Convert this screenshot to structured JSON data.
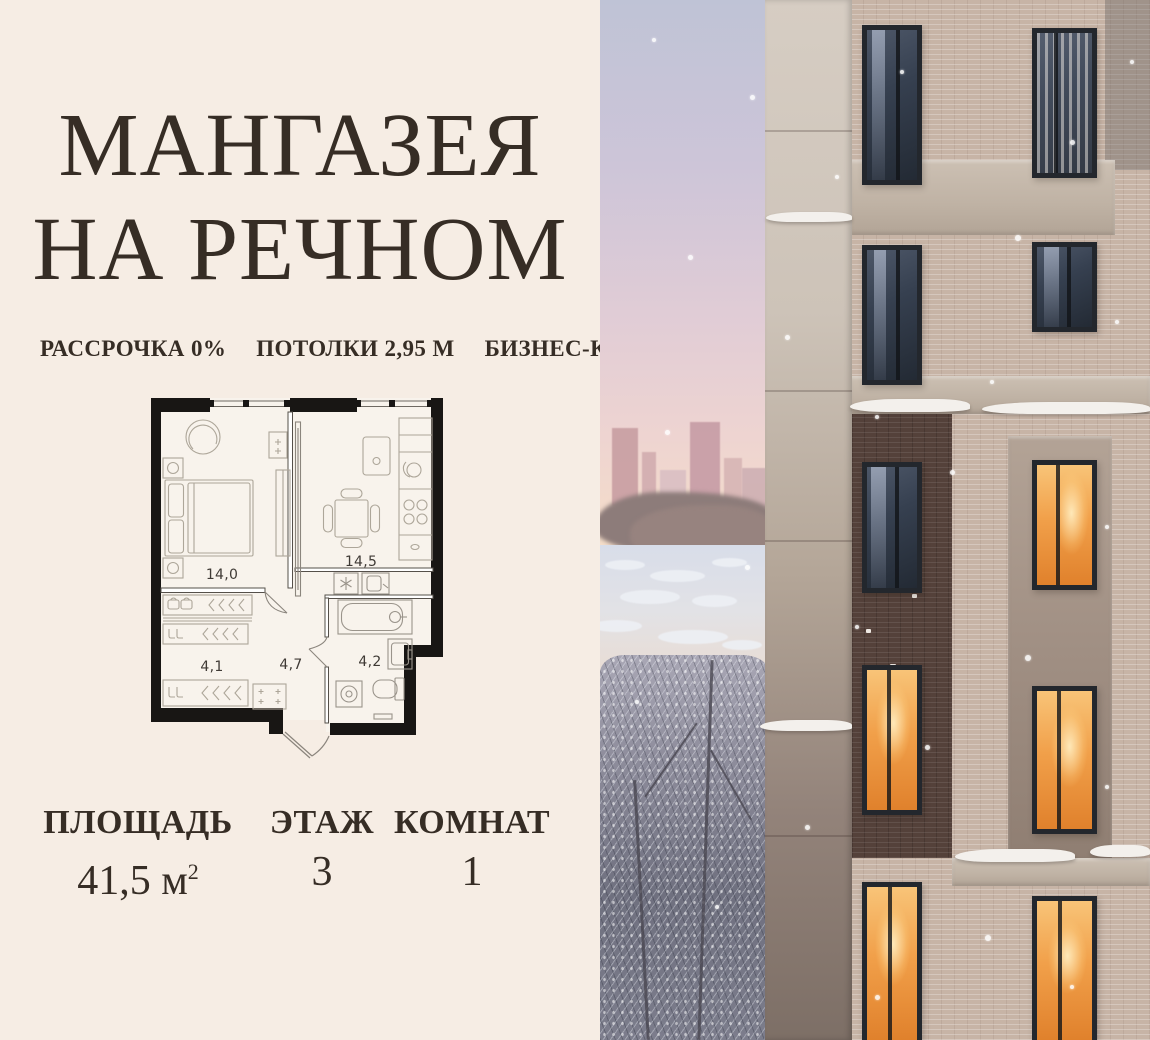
{
  "header": {
    "title_line1": "МАНГАЗЕЯ",
    "title_line2": "НА РЕЧНОМ"
  },
  "features": [
    {
      "label": "РАССРОЧКА 0%"
    },
    {
      "label": "ПОТОЛКИ 2,95 М"
    },
    {
      "label": "БИЗНЕС-КЛАСС"
    }
  ],
  "floorplan": {
    "rooms": [
      {
        "name": "bedroom",
        "area": "14,0"
      },
      {
        "name": "kitchen-living",
        "area": "14,5"
      },
      {
        "name": "wardrobe",
        "area": "4,1"
      },
      {
        "name": "hallway",
        "area": "4,7"
      },
      {
        "name": "bathroom",
        "area": "4,2"
      }
    ]
  },
  "stats": [
    {
      "label": "ПЛОЩАДЬ",
      "value": "41,5 м",
      "sup": "2"
    },
    {
      "label": "ЭТАЖ",
      "value": "3"
    },
    {
      "label": "КОМНАТ",
      "value": "1"
    }
  ],
  "colors": {
    "background": "#f6ede4",
    "ink": "#362d25",
    "light_brick": "#c7b4a6",
    "dark_brick": "#54413a",
    "warm_window": "#f1a04a",
    "sky_top": "#bfc3d6",
    "sky_pink": "#eed4d1"
  }
}
